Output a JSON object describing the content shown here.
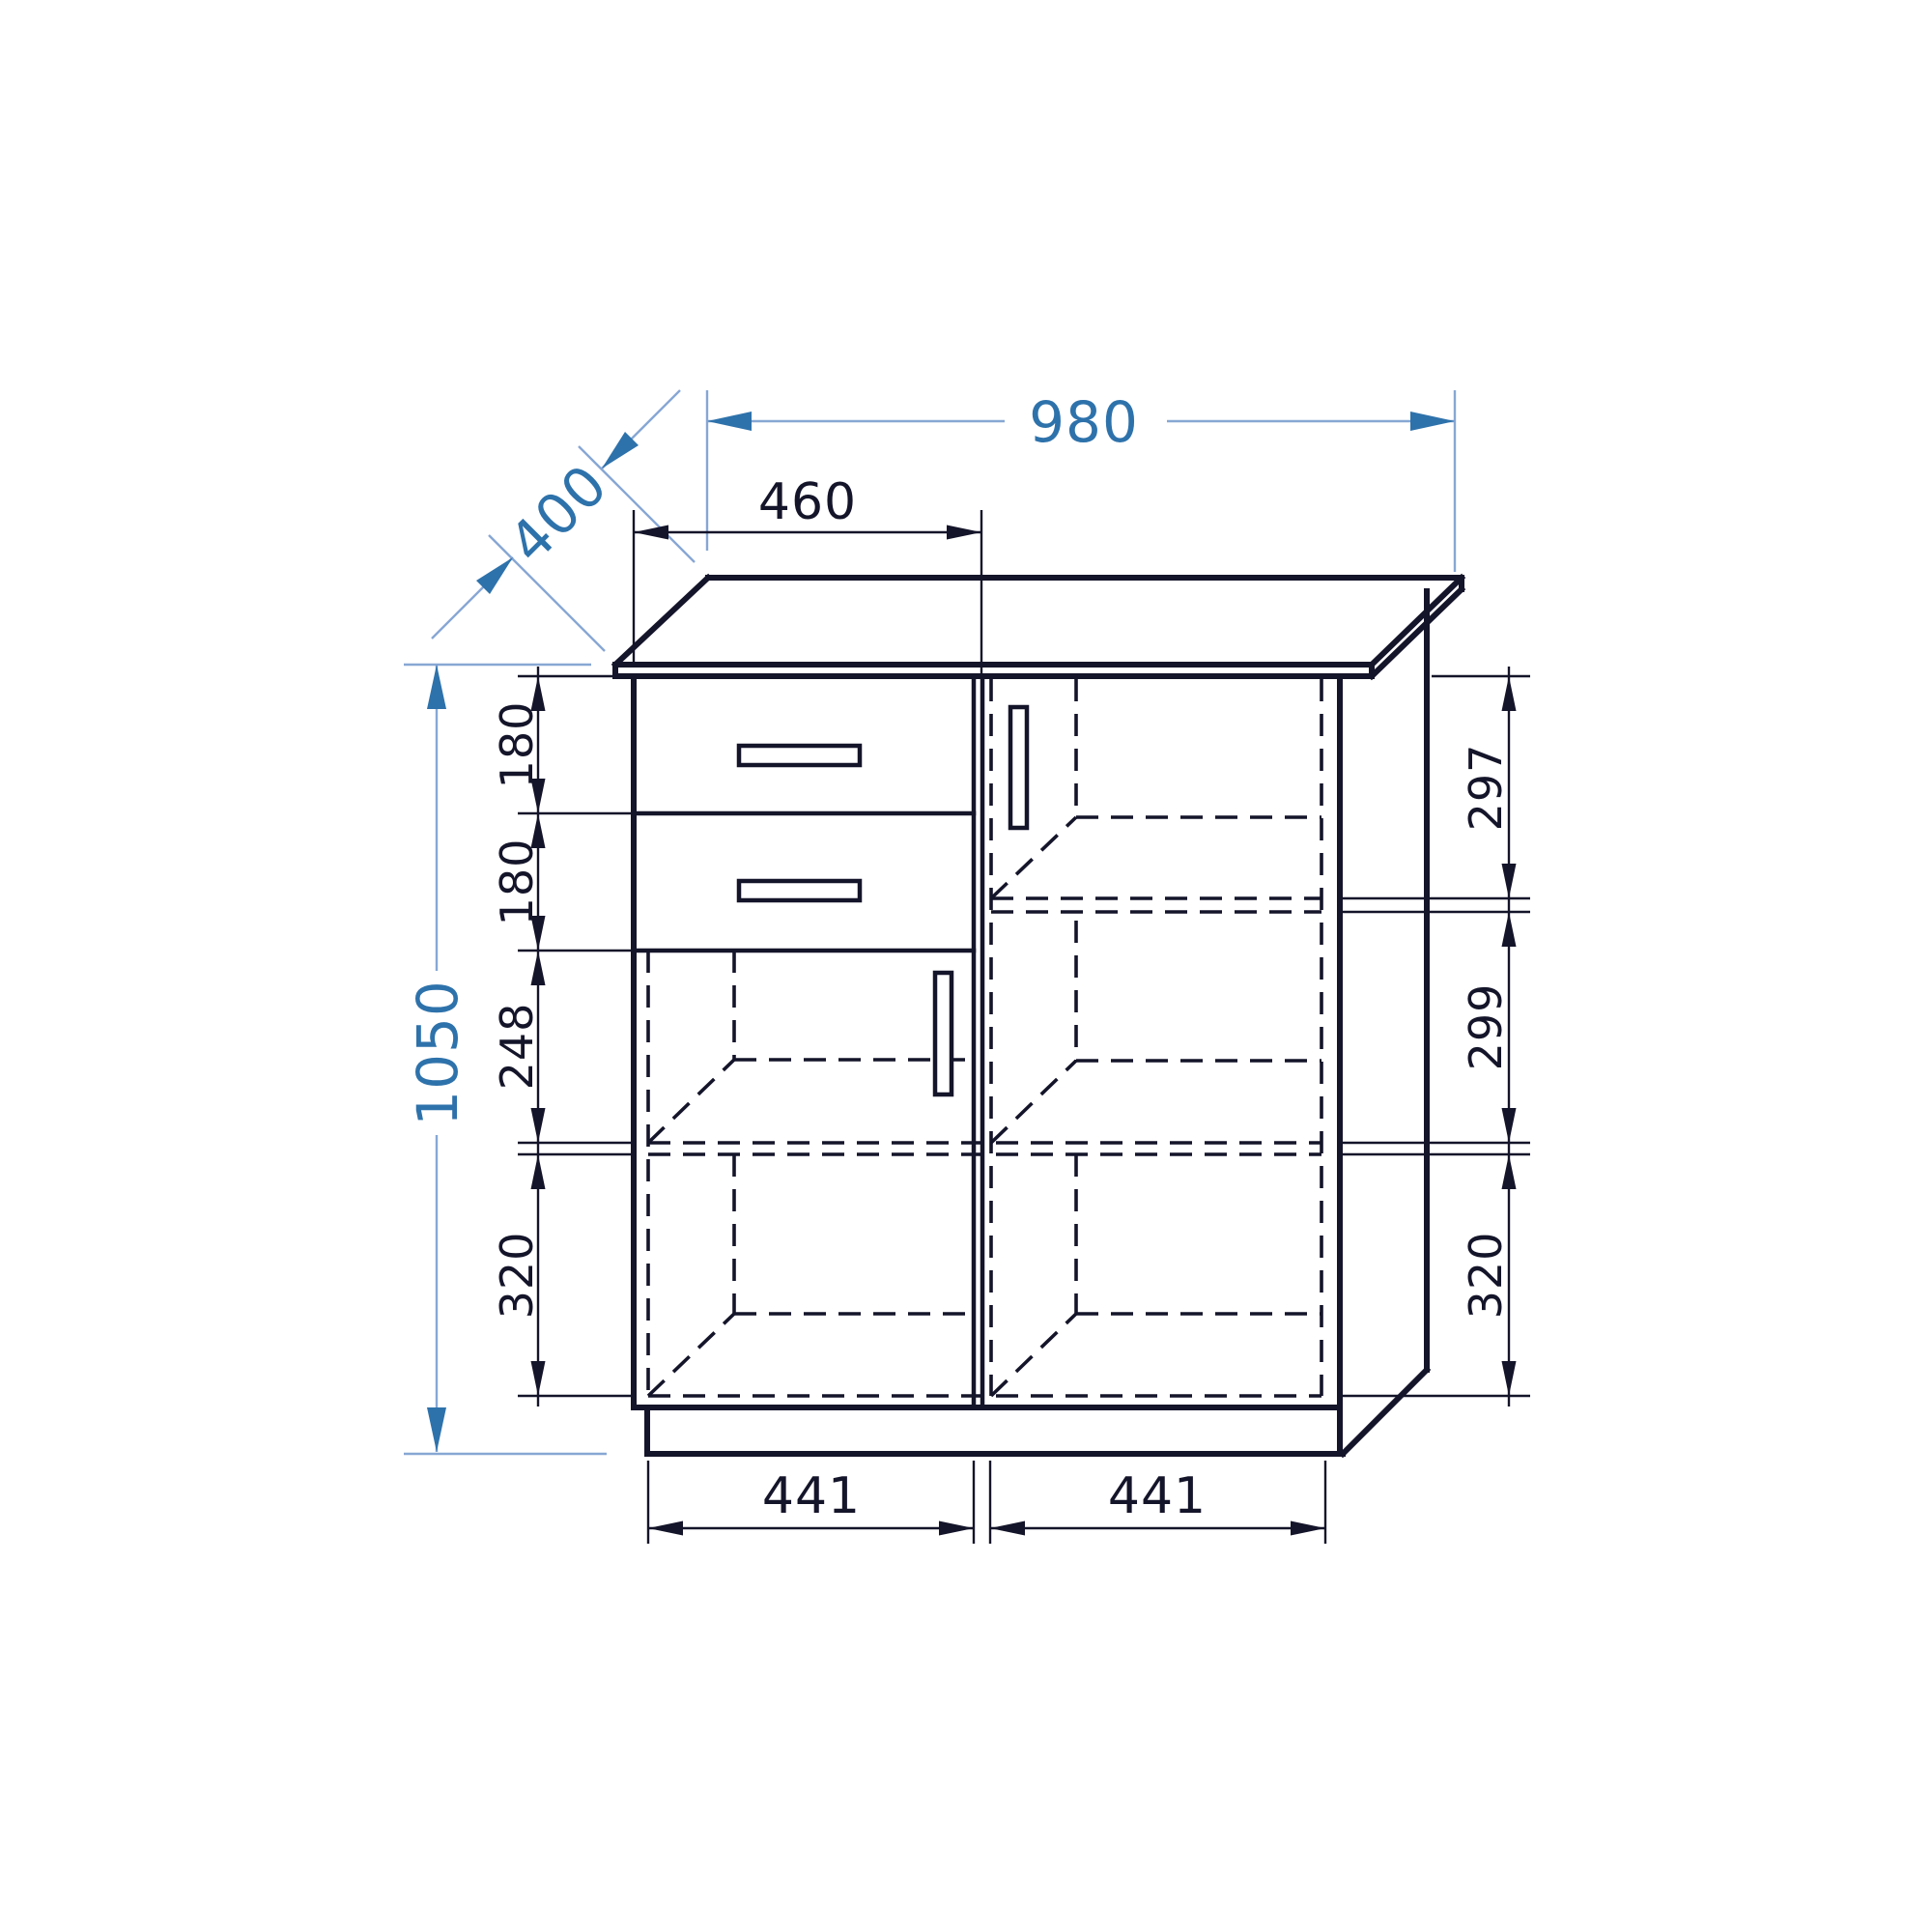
{
  "drawing": {
    "kind": "furniture-technical-drawing",
    "object": "two-door sideboard cabinet with two drawers, front elevation in oblique projection",
    "units": "mm",
    "colors": {
      "line": "#14142a",
      "accent_blue": "#2e72ab",
      "accent_blue_light": "#87a7d4",
      "background": "#ffffff"
    },
    "dims": {
      "total_width": "980",
      "depth": "400",
      "total_height": "1050",
      "left_section_width": "460",
      "left_heights": [
        "180",
        "180",
        "248",
        "320"
      ],
      "right_heights": [
        "297",
        "299",
        "320"
      ],
      "bottom_widths": [
        "441",
        "441"
      ]
    }
  }
}
